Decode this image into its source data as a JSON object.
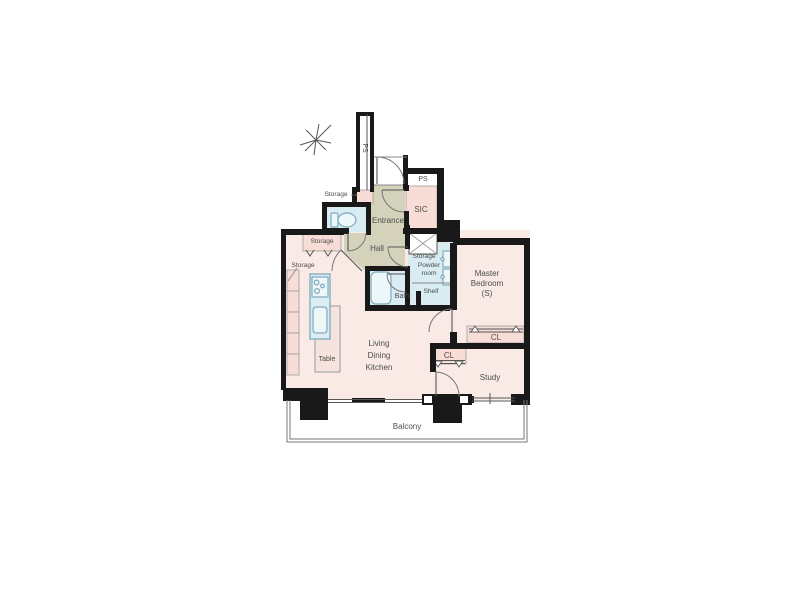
{
  "colors": {
    "wall": "#191919",
    "room": "#f9eae5",
    "closet": "#f8dcd6",
    "wet": "#d8ecf2",
    "hall": "#d5d2bc",
    "fixstroke": "#7ea9bf",
    "fixfill": "#edf6f9",
    "text": "#4c4c4c",
    "line": "#666666",
    "tablefill": "#f7e3de"
  },
  "floorplan": {
    "labels": {
      "ps_shaft": "PS",
      "ps_meter": "PS",
      "sic": "SIC",
      "storage_entry": "Storage",
      "entrance": "Entrance",
      "hall": "Hall",
      "storage_hall": "Storage",
      "storage_counter": "Storage",
      "storage_hatched": "Storage",
      "powder_1": "Powder",
      "powder_2": "room",
      "shelf": "Shelf",
      "bath": "Bath",
      "master_1": "Master",
      "master_2": "Bedroom",
      "master_3": "(S)",
      "cl_master": "CL",
      "cl_study": "CL",
      "study": "Study",
      "ldk_1": "Living",
      "ldk_2": "Dining",
      "ldk_3": "Kitchen",
      "table": "Table",
      "balcony": "Balcony"
    }
  }
}
